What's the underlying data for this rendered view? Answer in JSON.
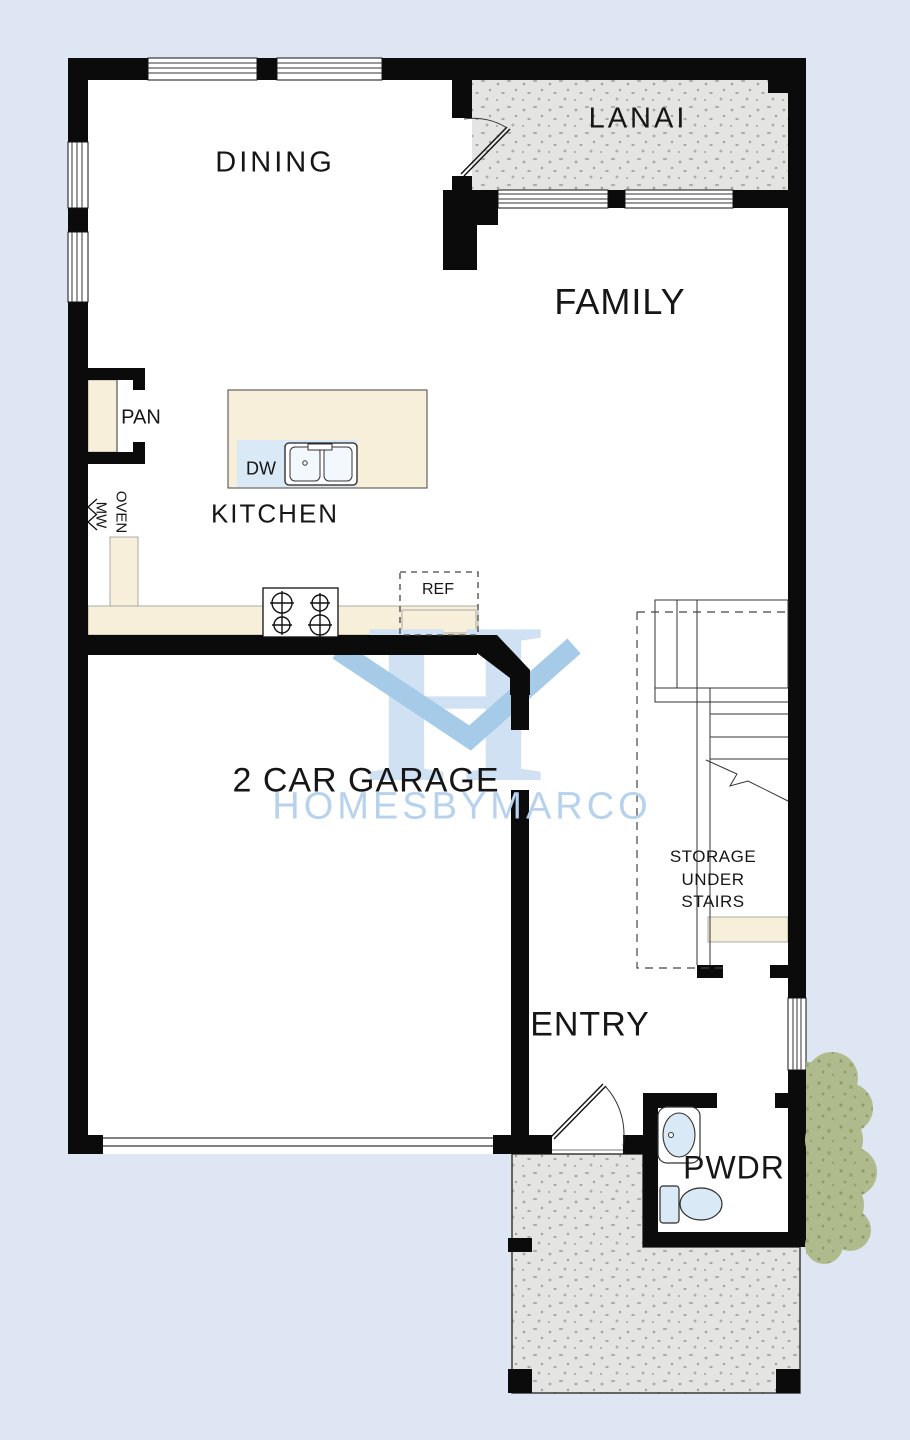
{
  "meta": {
    "type": "floor-plan",
    "width": 910,
    "height": 1440
  },
  "watermark": {
    "monogram": "H",
    "wordmark": "HOMESBYMARCO"
  },
  "rooms": {
    "dining": "DINING",
    "lanai": "LANAI",
    "family": "FAMILY",
    "kitchen": "KITCHEN",
    "garage": "2 CAR GARAGE",
    "entry": "ENTRY",
    "powder": "PWDR",
    "storage_line1": "STORAGE",
    "storage_line2": "UNDER",
    "storage_line3": "STAIRS"
  },
  "fixtures": {
    "pantry": "PAN",
    "dishwasher": "DW",
    "refrigerator": "REF",
    "oven": "OVEN",
    "microwave": "MW"
  },
  "colors": {
    "bg": "#dfe6f3",
    "floor": "#ffffff",
    "wall": "#0b0b0b",
    "ink": "#161616",
    "counter": "#f8efdb",
    "fixture": "#d9e9f6",
    "stippleBase": "#e4e5e2",
    "stippleDot": "#a7a7a4",
    "bushBase": "#b0bb8d",
    "bushDot": "#8e9a68",
    "wmH": "#cfe1f3",
    "wmM": "#a6cbe9",
    "wmText": "#b6d2ee"
  }
}
